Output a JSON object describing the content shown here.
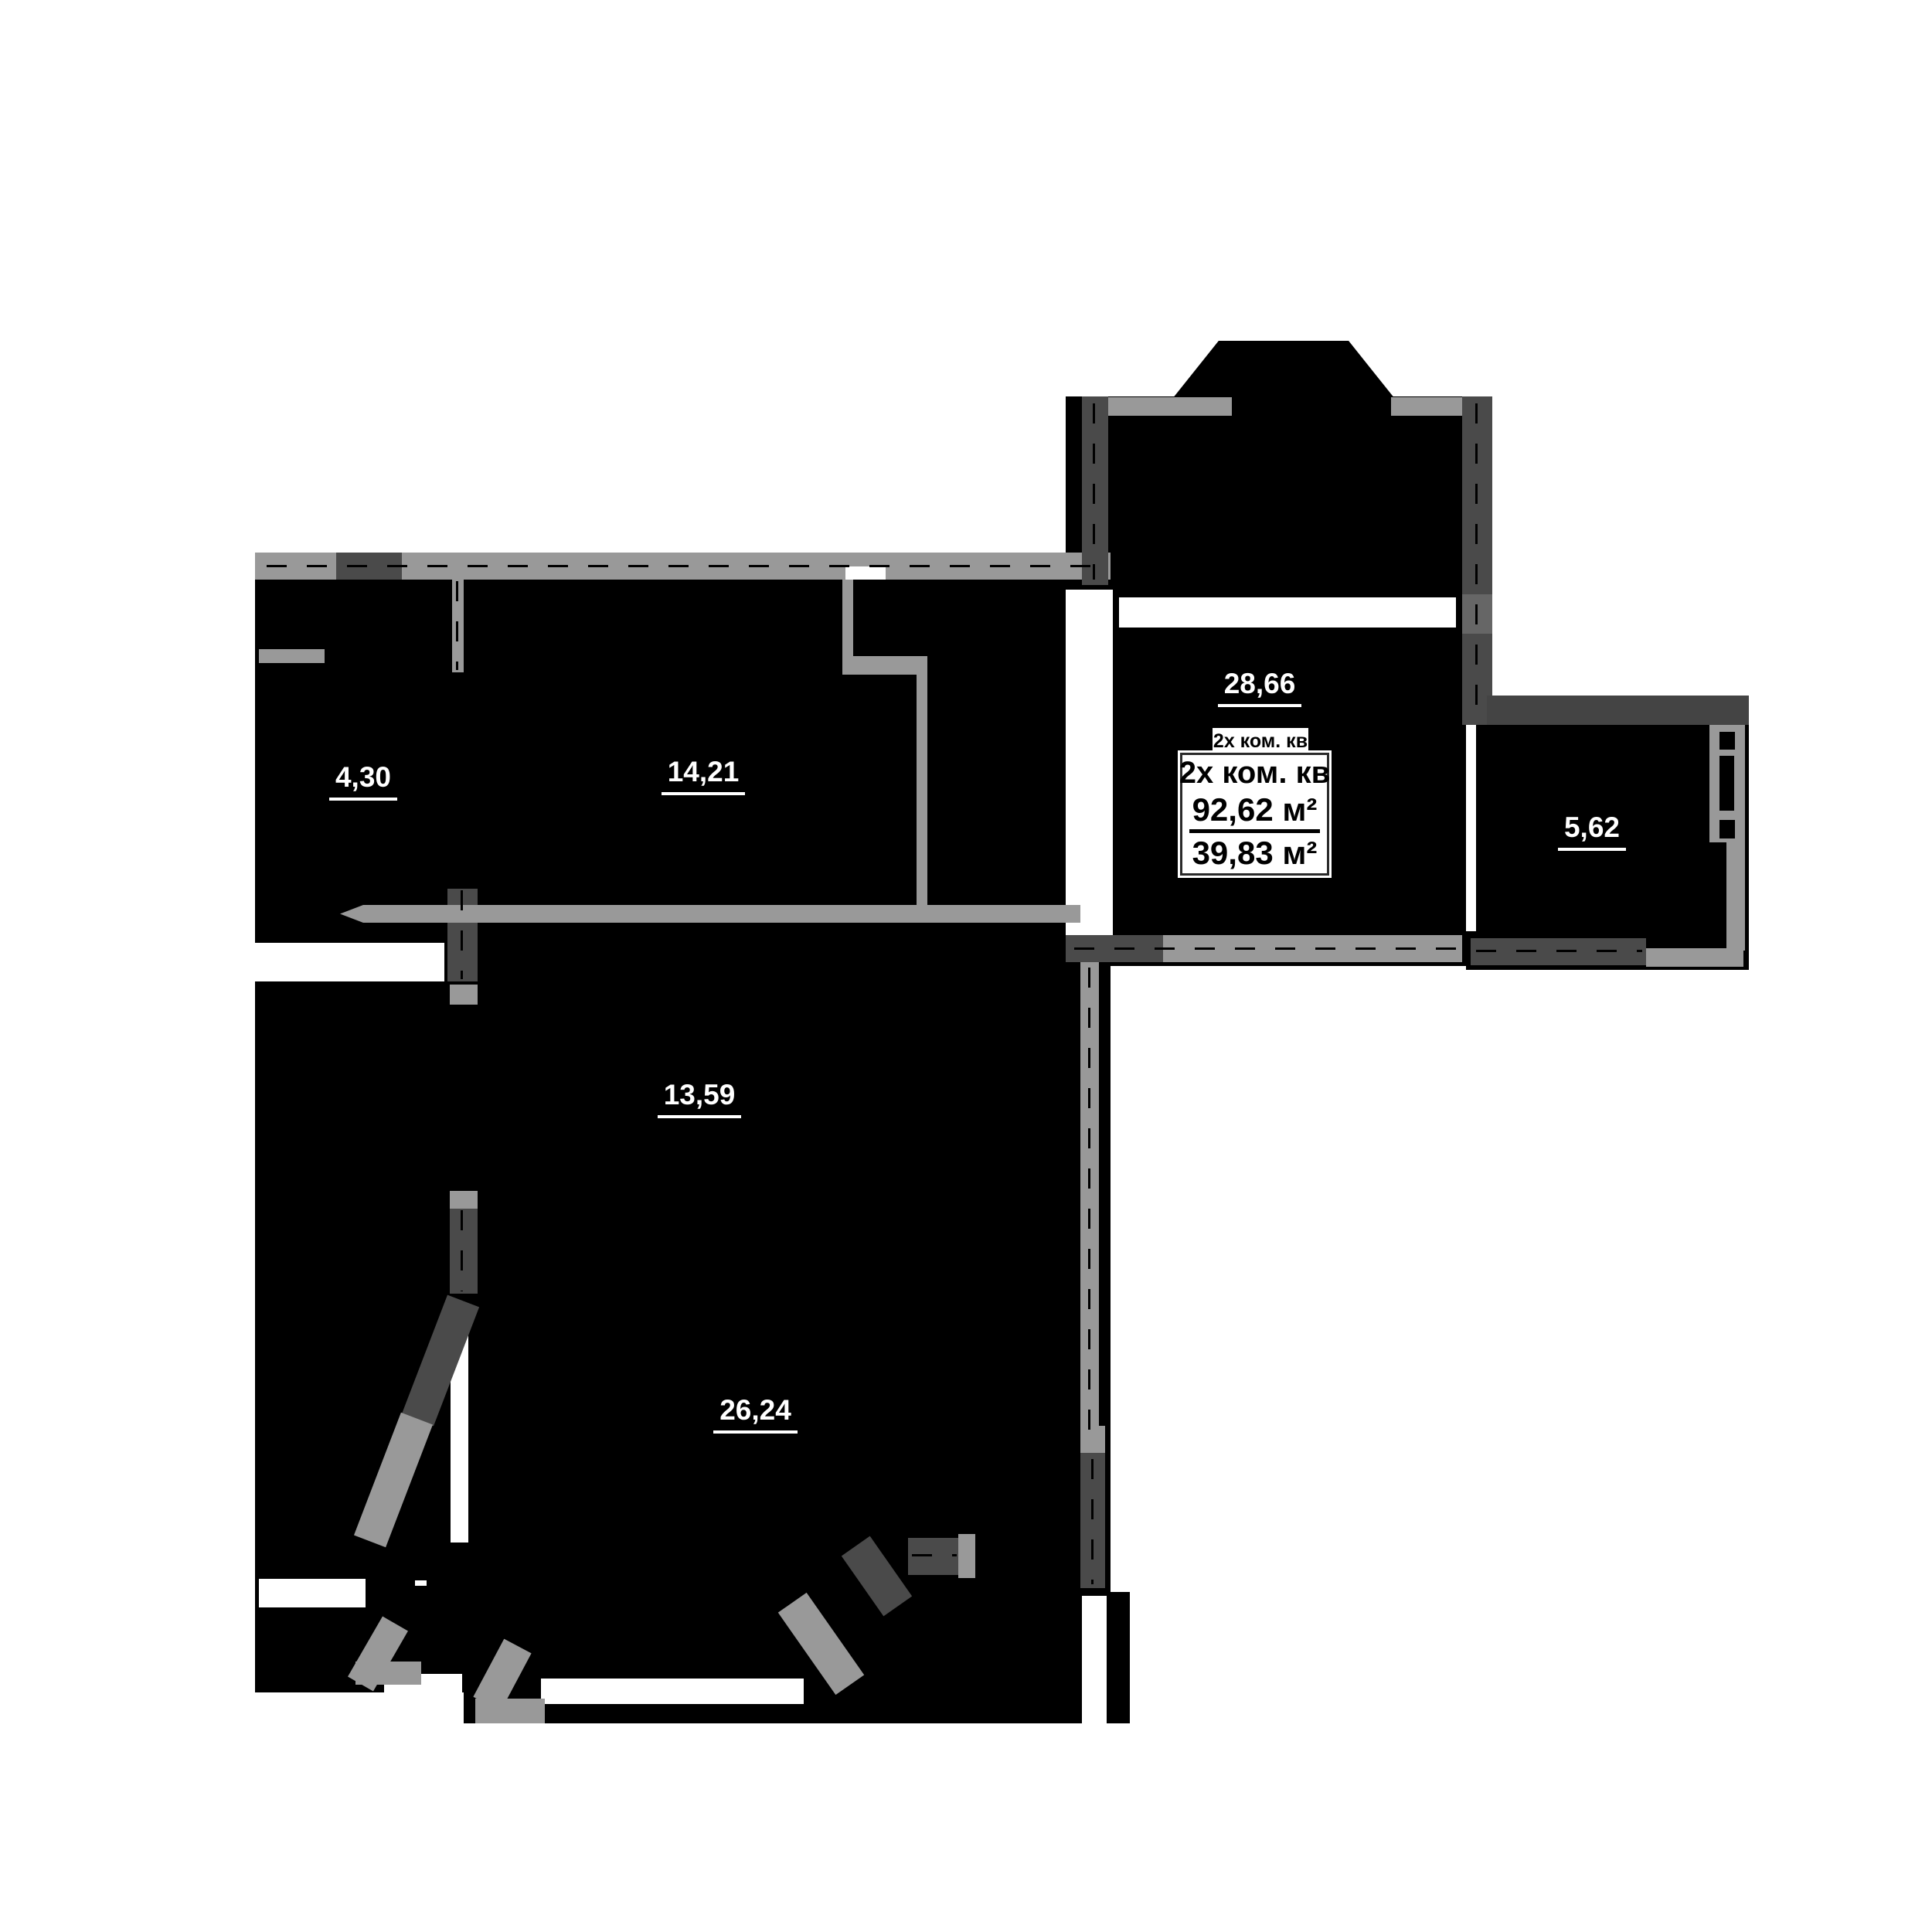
{
  "plan": {
    "title_tag": "2х ком. кв",
    "info_box": {
      "apartment_type": "2х ком. кв",
      "total_area": "92,62 м²",
      "living_area": "39,83 м²"
    },
    "rooms": [
      {
        "id": "room-4-30",
        "area": "4,30"
      },
      {
        "id": "room-14-21",
        "area": "14,21"
      },
      {
        "id": "room-28-66",
        "area": "28,66"
      },
      {
        "id": "room-13-59",
        "area": "13,59"
      },
      {
        "id": "room-26-24",
        "area": "26,24"
      },
      {
        "id": "balcony-5-62",
        "area": "5,62"
      }
    ],
    "colors": {
      "fill": "#000000",
      "wall_light": "#999999",
      "wall_dark": "#4a4a4a",
      "wall_mid": "#666666",
      "opening": "#ffffff"
    }
  }
}
